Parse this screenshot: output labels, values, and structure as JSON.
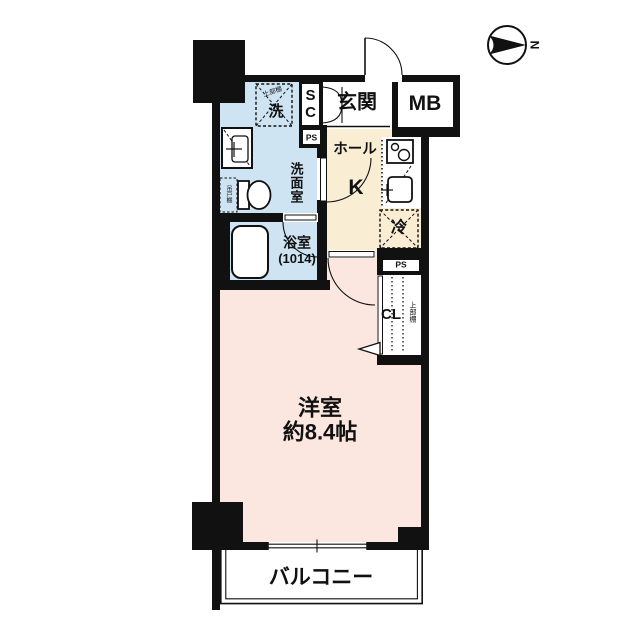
{
  "labels": {
    "entrance": "玄関",
    "meter_box": "MB",
    "shoe_closet": "SC",
    "pipe_space_top": "PS",
    "pipe_space_side": "PS",
    "hall": "ホール",
    "kitchen": "K",
    "fridge": "冷",
    "washer": "洗",
    "washer_shelf": "上部棚",
    "washroom": "洗面室",
    "toilet_shelf": "吊戸棚",
    "bath": "浴室",
    "bath_size": "(1014)",
    "closet": "CL",
    "closet_shelf": "上部棚",
    "room": "洋室",
    "room_size": "約8.4帖",
    "balcony": "バルコニー",
    "compass": "N"
  },
  "colors": {
    "wall": "#111111",
    "wet_area": "#cfe4f2",
    "hall_kitchen": "#f9eed3",
    "western_room": "#fce7e0",
    "line": "#111111",
    "background": "#ffffff"
  }
}
